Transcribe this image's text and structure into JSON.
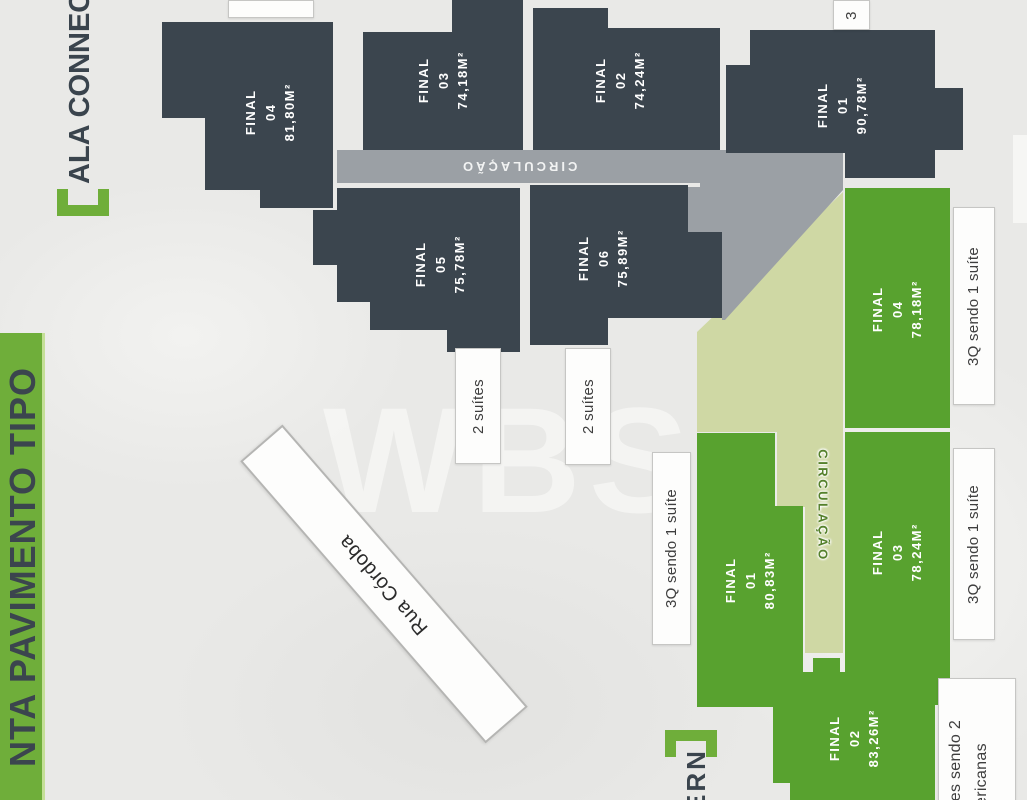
{
  "band": {
    "title": "NTA PAVIMENTO TIPO"
  },
  "wing_headers": {
    "top": "ALA CONNEC",
    "bottom": "ERN"
  },
  "icons": {
    "bracket_open": "[",
    "bracket_close": "]"
  },
  "dark_units": [
    {
      "label": "FINAL",
      "num": "04",
      "area": "81,80M²"
    },
    {
      "label": "FINAL",
      "num": "03",
      "area": "74,18M²"
    },
    {
      "label": "FINAL",
      "num": "02",
      "area": "74,24M²"
    },
    {
      "label": "FINAL",
      "num": "01",
      "area": "90,78M²"
    },
    {
      "label": "FINAL",
      "num": "05",
      "area": "75,78M²"
    },
    {
      "label": "FINAL",
      "num": "06",
      "area": "75,89M²"
    }
  ],
  "green_units": [
    {
      "label": "FINAL",
      "num": "04",
      "area": "78,18M²"
    },
    {
      "label": "FINAL",
      "num": "01",
      "area": "80,83M²"
    },
    {
      "label": "FINAL",
      "num": "03",
      "area": "78,24M²"
    },
    {
      "label": "FINAL",
      "num": "02",
      "area": "83,26M²"
    }
  ],
  "corridors": {
    "dark_wing": "CIRCULAÇÃO",
    "green_wing": "CIRCULAÇÃO"
  },
  "street": {
    "name": "Rua Córdoba"
  },
  "tags": {
    "top_partial": "3",
    "suites_a": "2 suítes",
    "suites_b": "2 suítes",
    "q3_right_top": "3Q sendo 1 suíte",
    "q3_left": "3Q sendo 1 suíte",
    "q3_right_bottom": "3Q sendo 1 suíte",
    "bottom_right_line1": "tes sendo 2",
    "bottom_right_line2": "ericanas",
    "top_cut": ""
  },
  "watermark": "WBS",
  "colors": {
    "brand_green": "#6fae3a",
    "unit_dark": "#3b454e",
    "unit_green": "#58a22f",
    "corridor_gray": "#9ba0a5",
    "circulation_pale": "#cfd8a4"
  }
}
